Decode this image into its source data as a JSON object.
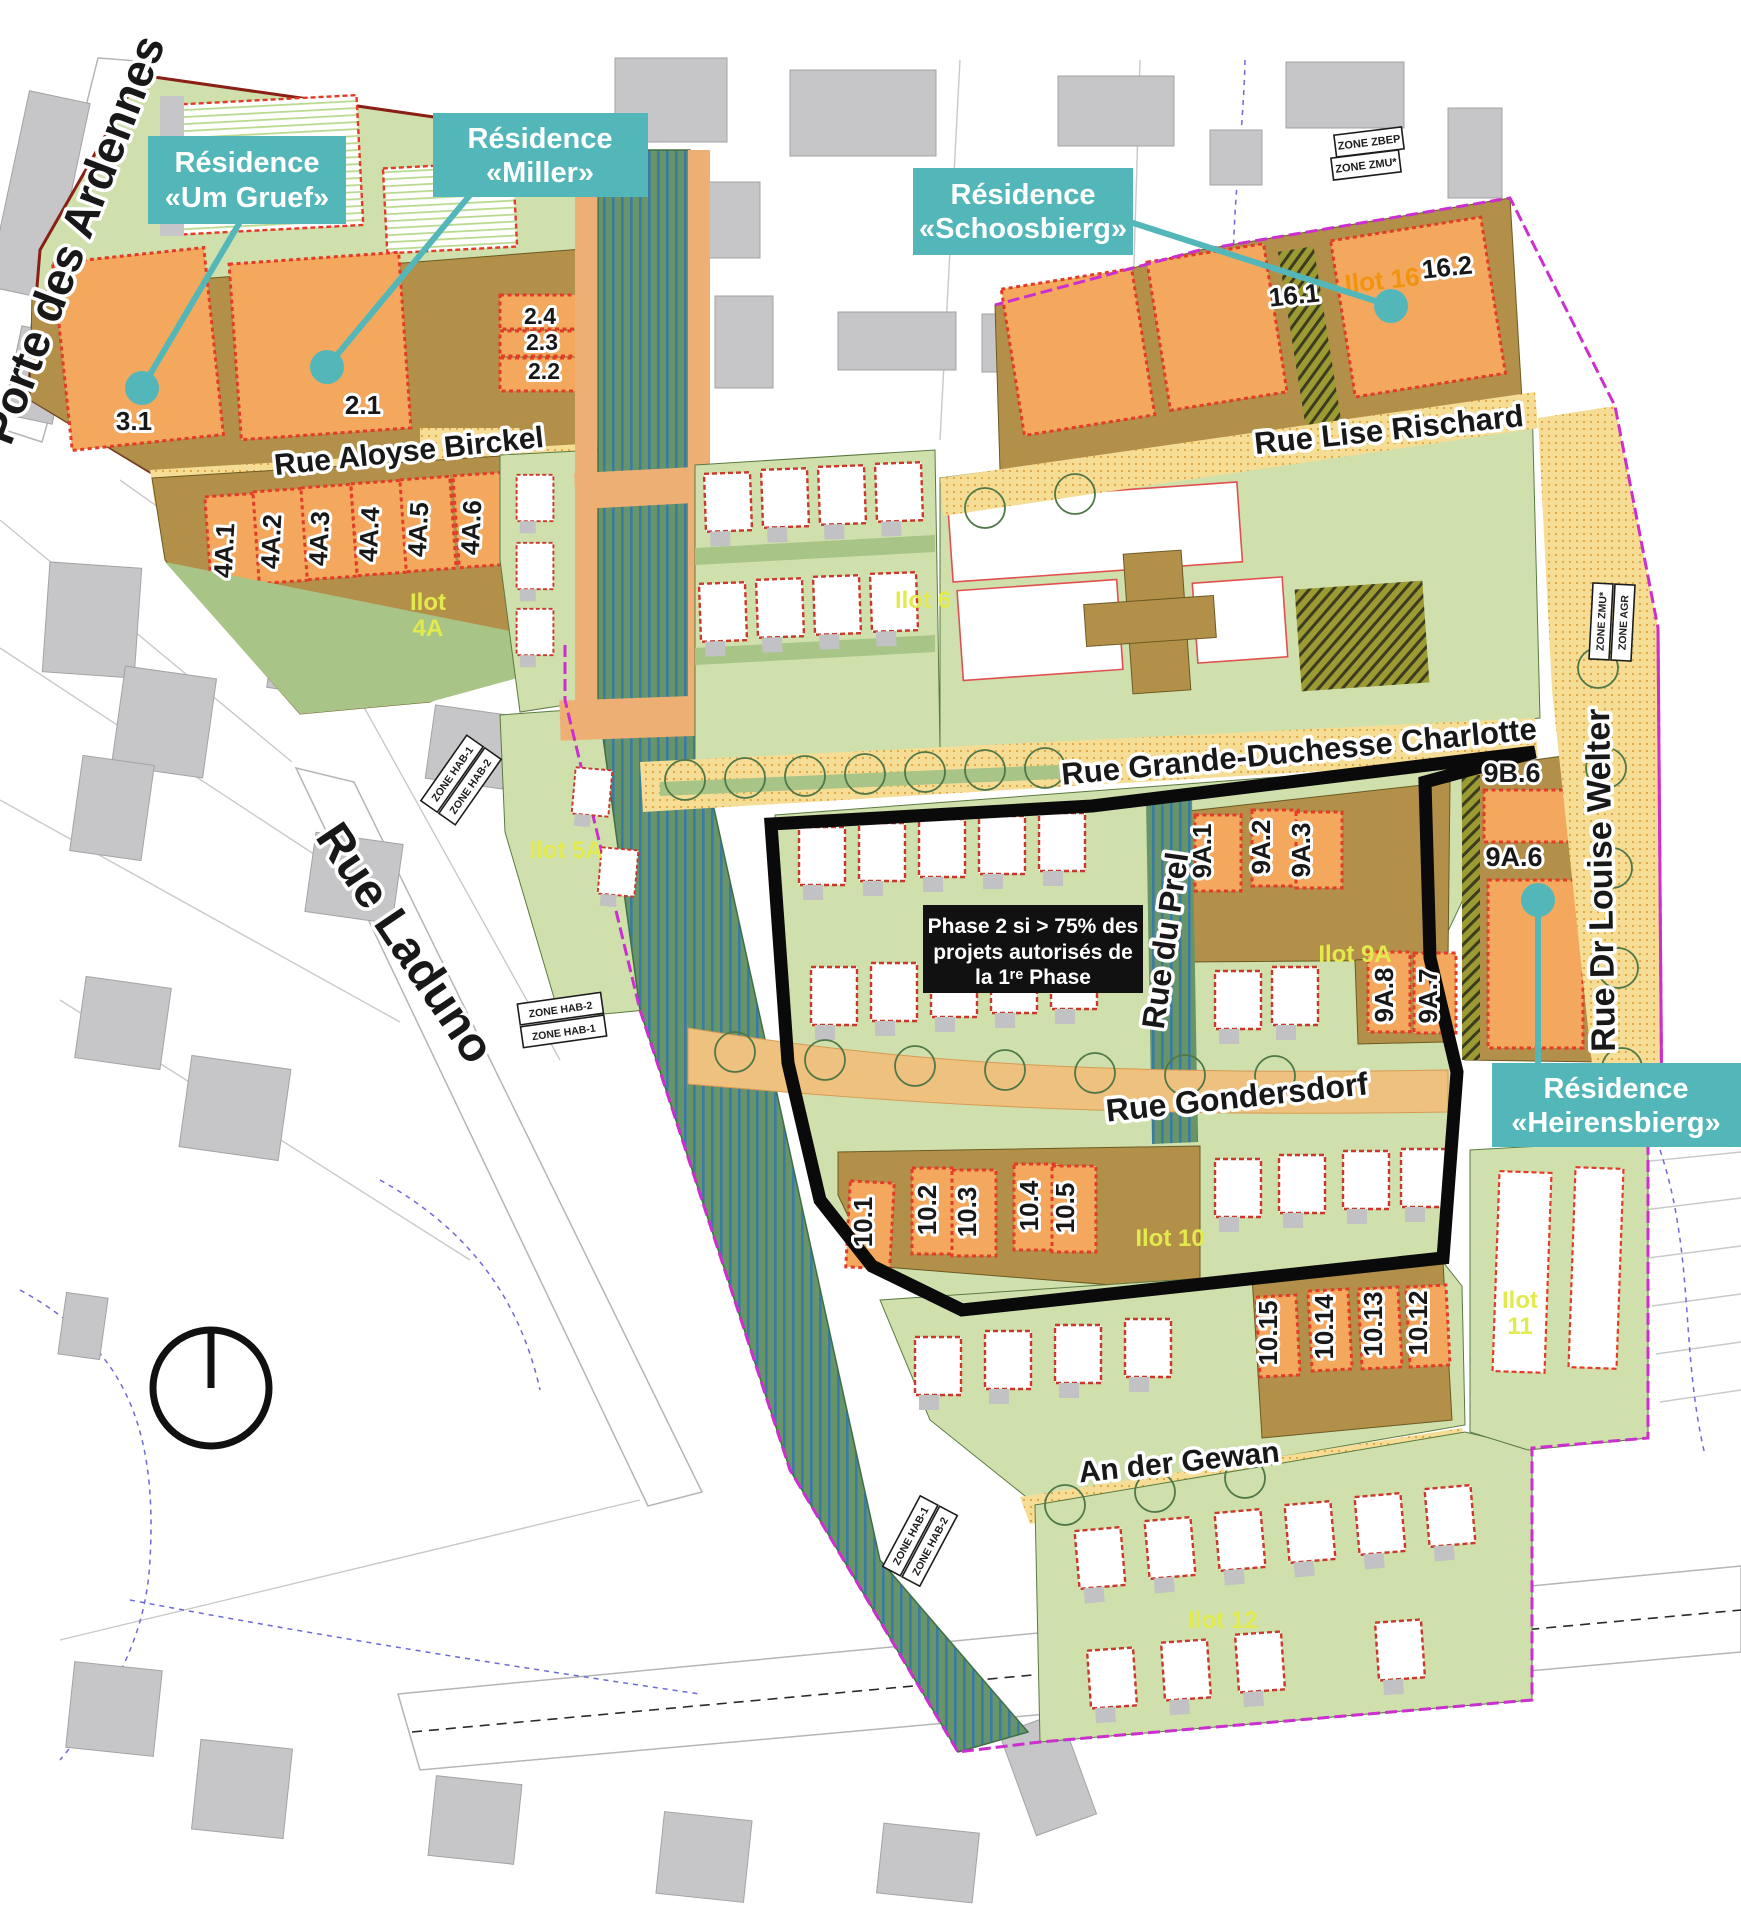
{
  "callouts": {
    "um_gruef": {
      "line1": "Résidence",
      "line2": "«Um Gruef»"
    },
    "miller": {
      "line1": "Résidence",
      "line2": "«Miller»"
    },
    "schoosbierg": {
      "line1": "Résidence",
      "line2": "«Schoosbierg»"
    },
    "heirensbierg": {
      "line1": "Résidence",
      "line2": "«Heirensbierg»"
    }
  },
  "phase_note": {
    "line1": "Phase 2 si > 75% des",
    "line2": "projets autorisés de",
    "line3": "la 1ʳᵉ Phase"
  },
  "streets": {
    "porte_des_ardennes": "Porte des Ardennes",
    "rue_aloyse_birckel": "Rue Aloyse Birckel",
    "rue_laduno": "Rue Laduno",
    "rue_lise_rischard": "Rue Lise Rischard",
    "rue_grande_duchesse_charlotte": "Rue Grande-Duchesse Charlotte",
    "rue_du_prel": "Rue du Prel",
    "rue_dr_louise_welter": "Rue Dr Louise Welter",
    "rue_gondersdorf": "Rue Gondersdorf",
    "an_der_gewan": "An der Gewan"
  },
  "lots": {
    "3_1": "3.1",
    "2_1": "2.1",
    "2_2": "2.2",
    "2_3": "2.3",
    "2_4": "2.4",
    "4A_1": "4A.1",
    "4A_2": "4A.2",
    "4A_3": "4A.3",
    "4A_4": "4A.4",
    "4A_5": "4A.5",
    "4A_6": "4A.6",
    "16_1": "16.1",
    "16_2": "16.2",
    "9A_1": "9A.1",
    "9A_2": "9A.2",
    "9A_3": "9A.3",
    "9A_6": "9A.6",
    "9A_7": "9A.7",
    "9A_8": "9A.8",
    "9B_6": "9B.6",
    "10_1": "10.1",
    "10_2": "10.2",
    "10_3": "10.3",
    "10_4": "10.4",
    "10_5": "10.5",
    "10_12": "10.12",
    "10_13": "10.13",
    "10_14": "10.14",
    "10_15": "10.15"
  },
  "ilots": {
    "i4A": {
      "l1": "Ilot",
      "l2": "4A"
    },
    "i5A": "Ilot 5A",
    "i6": "Ilot 6",
    "i9A": "Ilot 9A",
    "i10": "Ilot 10",
    "i11": {
      "l1": "Ilot",
      "l2": "11"
    },
    "i12": "Ilot 12",
    "i16": "Ilot 16"
  },
  "zones": {
    "zbep": "ZONE ZBEP",
    "zmu": "ZONE ZMU*",
    "hab1": "ZONE HAB-1",
    "hab2": "ZONE HAB-2",
    "agr": "ZONE AGR"
  },
  "colors": {
    "callout_teal": "#53b7ba",
    "phase_box_black": "#111111",
    "lot_orange": "#f4a85e",
    "block_olive": "#b3904a",
    "parcel_green": "#cfe0ac",
    "corridor_green": "#679468",
    "corridor_blue": "#3a7ba6",
    "street_yellow": "#f5dd95",
    "boundary_magenta": "#cc2fcf",
    "ilot_label_yellow": "#e3ea4e",
    "red_dashed": "#e23c28"
  }
}
